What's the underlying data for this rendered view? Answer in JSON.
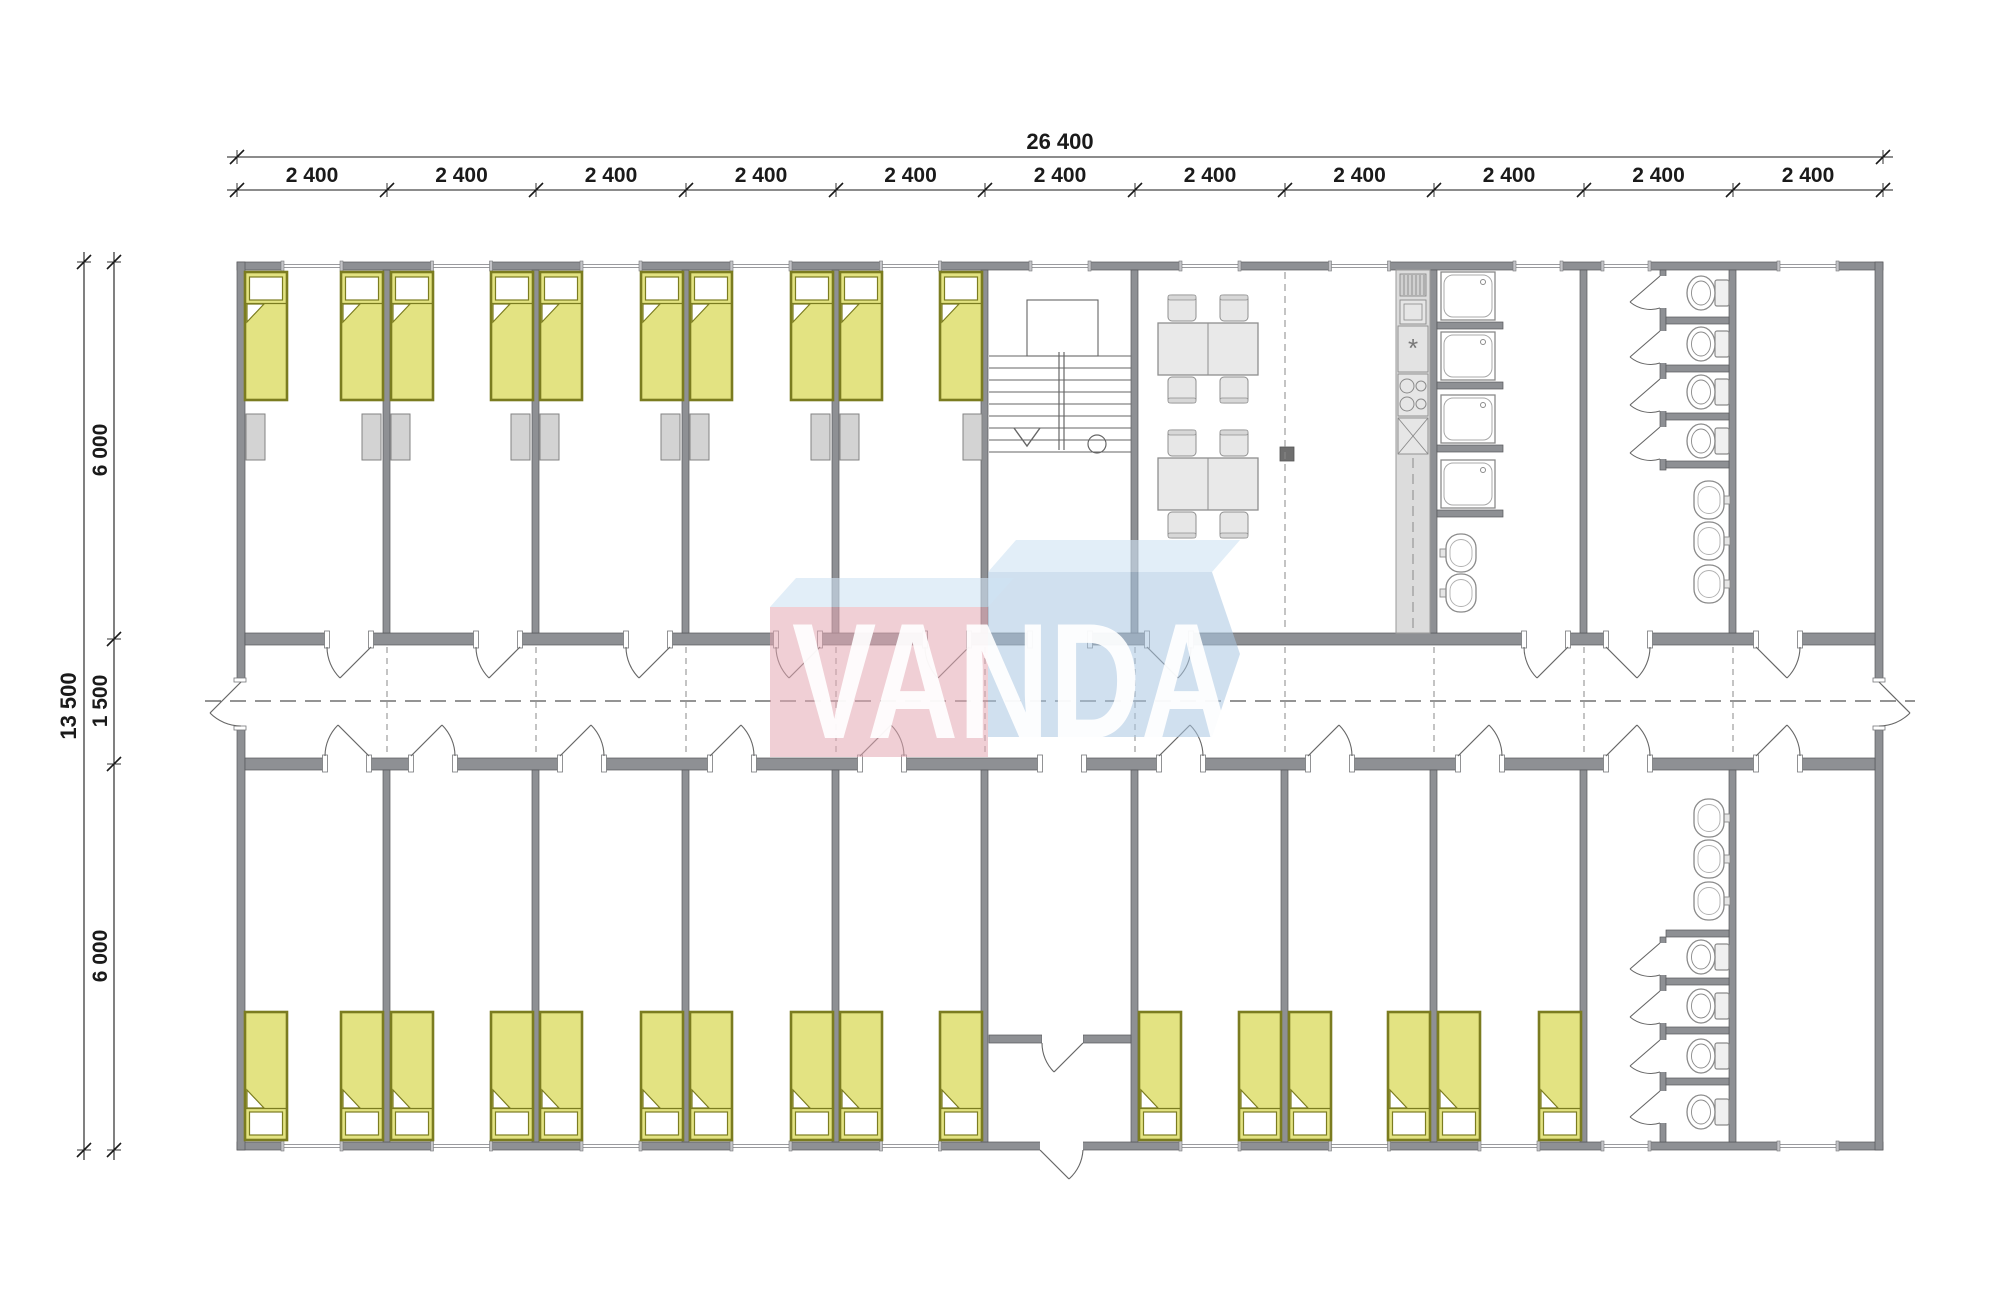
{
  "watermark": {
    "text": "VANDA"
  },
  "dimensions": {
    "total_width_label": "26 400",
    "module_width_labels": [
      "2 400",
      "2 400",
      "2 400",
      "2 400",
      "2 400",
      "2 400",
      "2 400",
      "2 400",
      "2 400",
      "2 400",
      "2 400"
    ],
    "total_height_label": "13 500",
    "left_segment_labels": [
      "6 000",
      "1 500",
      "6 000"
    ]
  },
  "colors": {
    "wall": "#8e9094",
    "wall_edge": "#57585b",
    "bed_fill": "#e3e382",
    "bed_border": "#7b7c20",
    "locker_fill": "#d3d3d3",
    "furniture_fill": "#e7e7e7",
    "furniture_stroke": "#8f8f8f",
    "fixture_stroke": "#8a8a8a",
    "counter_fill": "#dcdcdc",
    "dash": "#666666",
    "dim": "#1a1a1a",
    "column": "#6f6f6f",
    "watermark_pink": "#e4a7b2",
    "watermark_blue": "#a9c6e2",
    "watermark_blue_light": "#cfe2f4"
  },
  "fixtures": {
    "beds": 26,
    "lockers": 10,
    "toilets": 8,
    "showers": 4,
    "washbasins": 8,
    "dining_tables": 2,
    "chairs": 8,
    "staircases": 1
  }
}
